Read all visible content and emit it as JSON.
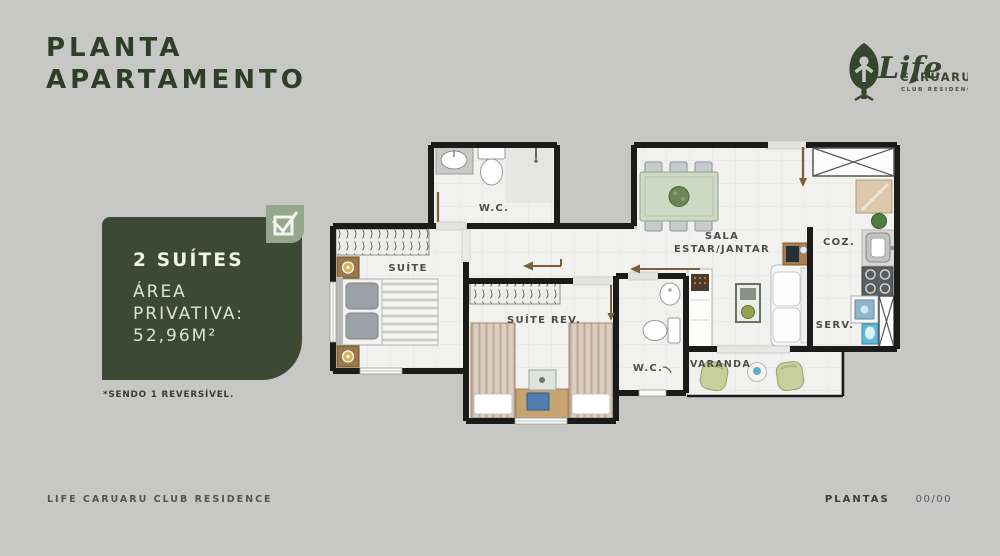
{
  "page": {
    "background": "#c7c7c5"
  },
  "header": {
    "title_line1": "PLANTA",
    "title_line2": "APARTAMENTO"
  },
  "logo": {
    "brand": "Life",
    "city": "CARUARU",
    "subtitle": "CLUB RESIDENCE",
    "icon": "tree-leaf-person-icon",
    "color": "#35462e"
  },
  "info_card": {
    "headline": "2 SUÍTES",
    "area_line1": "ÁREA",
    "area_line2": "PRIVATIVA:",
    "area_value": "52,96M²",
    "badge_icon": "checkbox-check",
    "bg_color": "#3c4935",
    "badge_color": "#95a88d"
  },
  "footnote": "*SENDO 1 REVERSÍVEL.",
  "floorplan": {
    "rooms": {
      "wc_suite": "W.C.",
      "suite": "SUÍTE",
      "suite_rev": "SUÍTE REV.",
      "sala_line1": "SALA",
      "sala_line2": "ESTAR/JANTAR",
      "cozinha": "COZ.",
      "servico": "SERV.",
      "varanda": "VARANDA",
      "wc_rev": "W.C."
    },
    "wall_color": "#1b1b1a",
    "door_color": "#7d5f3a",
    "floor_color": "#f1f1ef"
  },
  "footer": {
    "left": "LIFE CARUARU CLUB RESIDENCE",
    "right_label": "PLANTAS",
    "right_value": "00/00"
  }
}
